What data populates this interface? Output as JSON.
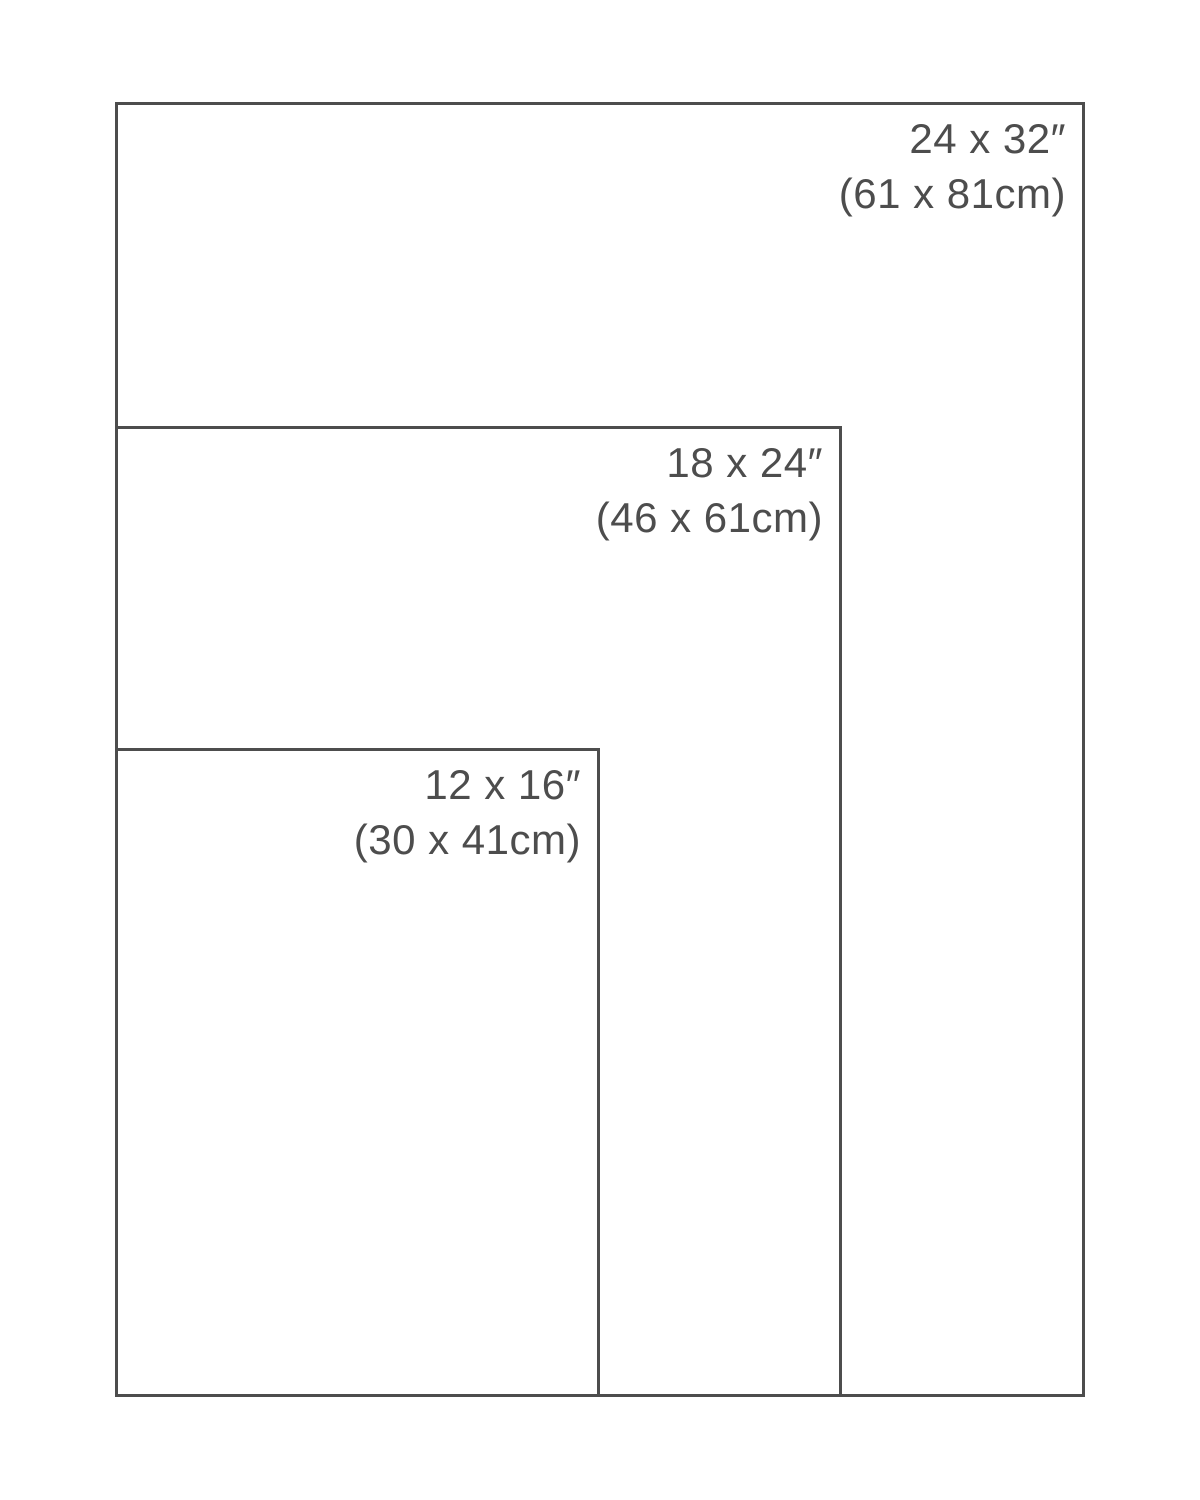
{
  "diagram": {
    "title": "print-size-comparison",
    "colors": {
      "line": "#4d4d4d",
      "text": "#4d4d4d",
      "background": "#ffffff"
    },
    "sizes": [
      {
        "name": "24x32",
        "inches": "24 x 32″",
        "cm": "(61 x 81cm)"
      },
      {
        "name": "18x24",
        "inches": "18 x 24″",
        "cm": "(46 x 61cm)"
      },
      {
        "name": "12x16",
        "inches": "12 x 16″",
        "cm": "(30 x 41cm)"
      }
    ]
  }
}
